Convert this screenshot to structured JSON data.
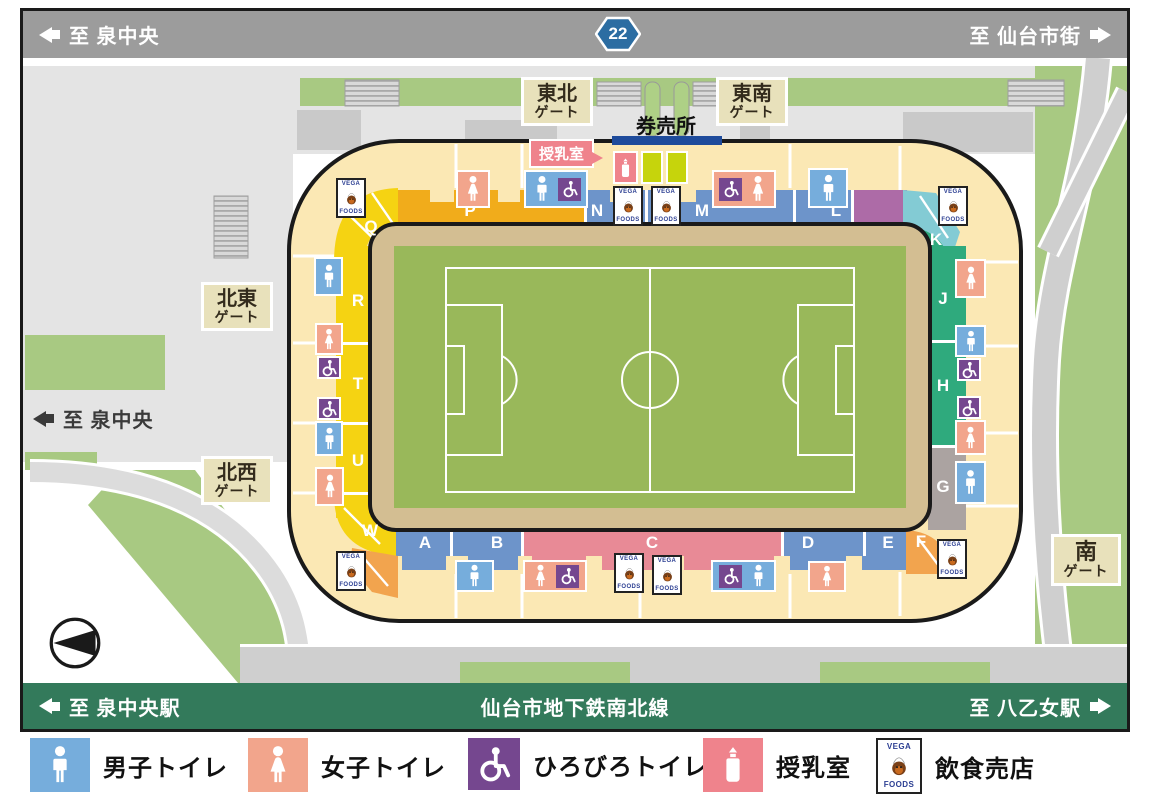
{
  "top_bar": {
    "left_label": "至 泉中央",
    "route_badge": "22",
    "right_label": "至 仙台市街"
  },
  "bottom_bar": {
    "left_label": "至 泉中央駅",
    "center_label": "仙台市地下鉄南北線",
    "right_label": "至 八乙女駅"
  },
  "map_labels": {
    "ticket_office": "券売所",
    "nursing_room_callout": "授乳室",
    "to_izumi_chuo": "至 泉中央",
    "gate_tohoku": {
      "line1": "東北",
      "line2": "ゲート"
    },
    "gate_tonan": {
      "line1": "東南",
      "line2": "ゲート"
    },
    "gate_hokuto": {
      "line1": "北東",
      "line2": "ゲート"
    },
    "gate_hokusei": {
      "line1": "北西",
      "line2": "ゲート"
    },
    "gate_minami": {
      "line1": "南",
      "line2": "ゲート"
    }
  },
  "stadium": {
    "section_labels": {
      "A": "A",
      "B": "B",
      "C": "C",
      "D": "D",
      "E": "E",
      "F": "F",
      "G": "G",
      "H": "H",
      "J": "J",
      "K": "K",
      "L": "L",
      "M": "M",
      "N": "N",
      "P": "P",
      "Q": "Q",
      "R": "R",
      "T": "T",
      "U": "U",
      "W": "W"
    }
  },
  "vega_logo": {
    "top": "VEGA",
    "bottom": "FOODS"
  },
  "legend": {
    "items": [
      {
        "label": "男子トイレ",
        "icon": "men-toilet-icon",
        "color": "#76ADDC"
      },
      {
        "label": "女子トイレ",
        "icon": "women-toilet-icon",
        "color": "#F2A58C"
      },
      {
        "label": "ひろびろトイレ",
        "icon": "accessible-toilet-icon",
        "color": "#75478F"
      },
      {
        "label": "授乳室",
        "icon": "nursing-room-icon",
        "color": "#EF838C"
      },
      {
        "label": "飲食売店",
        "icon": "food-shop-icon",
        "color": "#FFFFFF"
      }
    ]
  },
  "colors": {
    "road_bar_gray": "#9C9C9C",
    "subway_bar_green": "#337A5B",
    "route_badge_blue": "#2C6DA2",
    "concourse_cream": "#FBE8B4",
    "stand_yellow": "#F5D312",
    "stand_orange": "#F1AC1B",
    "stand_blue": "#6D94CA",
    "stand_pink": "#E88A96",
    "stand_teal": "#2FAA7D",
    "stand_purple": "#AD6BA7",
    "stand_cyan": "#83CBD4",
    "stand_gray": "#ABA3A1",
    "field_green": "#99B85A",
    "field_tan": "#D3BE92",
    "grass_green": "#A8C982",
    "ticket_bar_navy": "#1E4B9B",
    "gate_label_beige": "#E8E1BB"
  }
}
